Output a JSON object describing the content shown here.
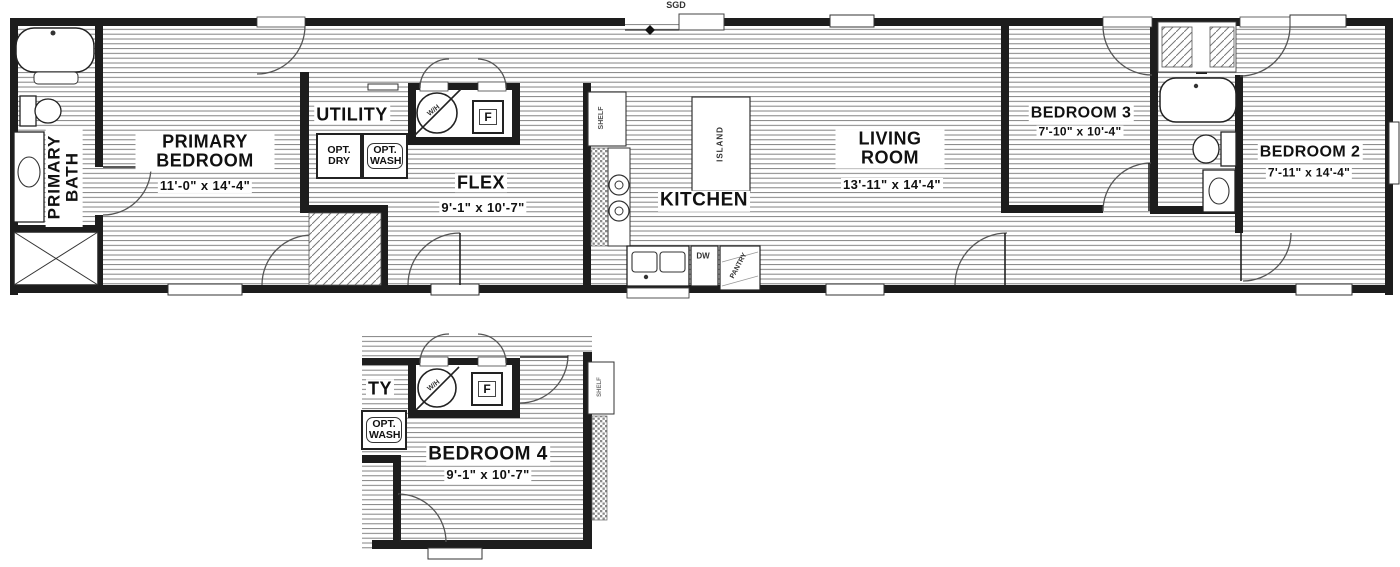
{
  "floorplan": {
    "top_label": "SGD",
    "rooms": {
      "primary_bath": {
        "name": "PRIMARY BATH"
      },
      "primary_bedroom": {
        "name": "PRIMARY BEDROOM",
        "dims": "11'-0\" x 14'-4\""
      },
      "utility": {
        "name": "UTILITY"
      },
      "flex": {
        "name": "FLEX",
        "dims": "9'-1\" x 10'-7\""
      },
      "kitchen": {
        "name": "KITCHEN"
      },
      "living_room": {
        "name": "LIVING ROOM",
        "dims": "13'-11\" x 14'-4\""
      },
      "bedroom_3": {
        "name": "BEDROOM 3",
        "dims": "7'-10\" x 10'-4\""
      },
      "bedroom_2": {
        "name": "BEDROOM 2",
        "dims": "7'-11\" x 14'-4\""
      }
    },
    "fixtures": {
      "opt_dry": "OPT. DRY",
      "opt_wash": "OPT. WASH",
      "water_heater": "W/H",
      "furnace": "F",
      "shelf": "SHELF",
      "island": "ISLAND",
      "dishwasher": "DW",
      "pantry": "PANTRY"
    },
    "inset": {
      "bedroom_4": {
        "name": "BEDROOM 4",
        "dims": "9'-1\" x 10'-7\""
      },
      "utility_partial": "TY",
      "opt_wash": "OPT. WASH",
      "water_heater": "W/H",
      "furnace": "F",
      "shelf": "SHELF"
    },
    "colors": {
      "wall": "#1d1d1d",
      "stripe": "#757575",
      "text": "#111111"
    }
  }
}
